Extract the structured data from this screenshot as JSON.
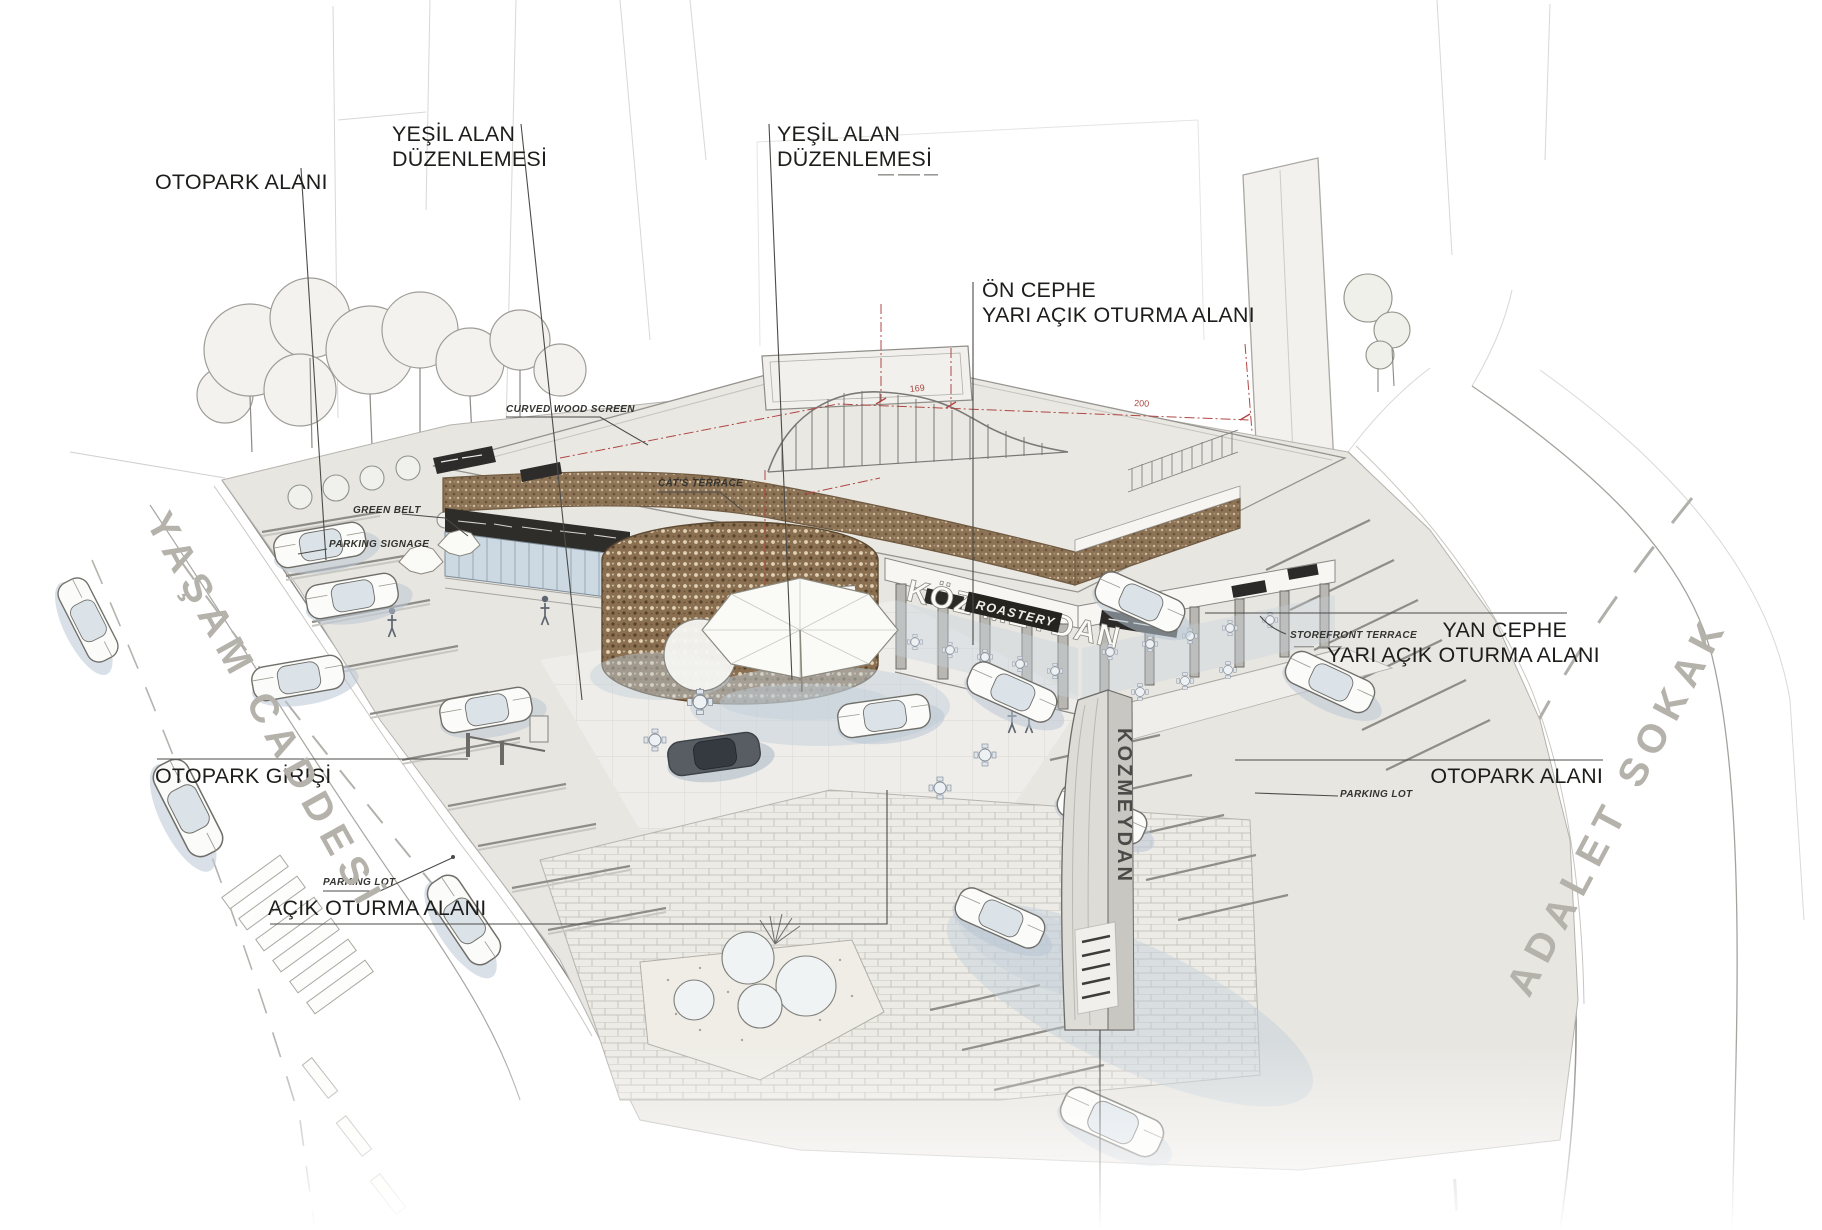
{
  "labels": {
    "otopark_left": "OTOPARK ALANI",
    "yesil1_l1": "YEŞİL ALAN",
    "yesil1_l2": "DÜZENLEMESİ",
    "yesil2_l1": "YEŞİL ALAN",
    "yesil2_l2": "DÜZENLEMESİ",
    "on_cephe_l1": "ÖN CEPHE",
    "on_cephe_l2": "YARI AÇIK OTURMA ALANI",
    "yan_cephe_l1": "YAN CEPHE",
    "yan_cephe_l2": "YARI AÇIK OTURMA ALANI",
    "otopark_right": "OTOPARK ALANI",
    "otopark_girisi": "OTOPARK GİRİŞİ",
    "acik_oturma": "AÇIK OTURMA ALANI"
  },
  "small": {
    "curved_wood_screen": "CURVED WOOD SCREEN",
    "green_belt": "GREEN BELT",
    "parking_signage": "PARKING SIGNAGE",
    "cats_terrace": "CAT'S TERRACE",
    "storefront_terrace": "STOREFRONT TERRACE",
    "parking_lot": "PARKING LOT",
    "parking_lot_right": "PARKING LOT"
  },
  "streets": {
    "left": "YAŞAM CADDESİ",
    "right": "ADALET SOKAK"
  },
  "signs": {
    "main": "KÖZ MEYDAN",
    "sub": "ROASTERY",
    "totem": "KOZMEYDAN",
    "tower": "LANNON"
  },
  "dims": {
    "d1": "169",
    "d2": "200"
  },
  "colors": {
    "wood": "#8d7356",
    "glass": "#ccd9e2",
    "shadow": "#bac7d3",
    "dimension_red": "#b04745",
    "street_gray": "#b5b2ab",
    "label_black": "#1d1d1b"
  }
}
